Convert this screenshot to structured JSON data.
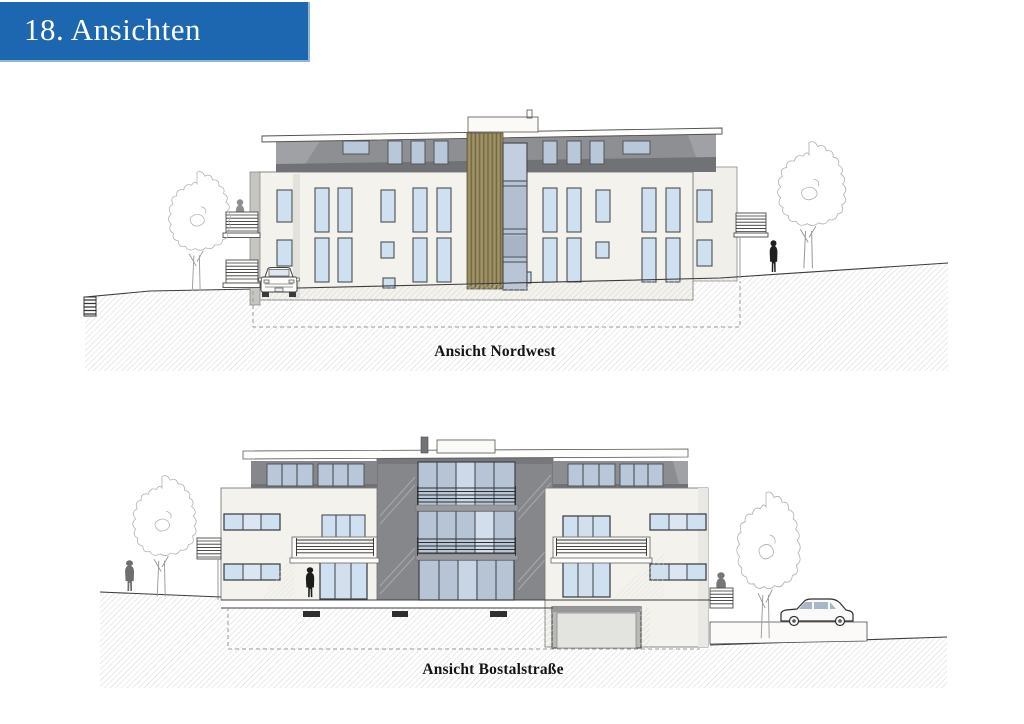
{
  "page": {
    "title": "18. Ansichten"
  },
  "drawings": [
    {
      "id": "nordwest",
      "caption": "Ansicht Nordwest"
    },
    {
      "id": "bostalstrasse",
      "caption": "Ansicht Bostalstraße"
    }
  ],
  "icons": {
    "trees": "deciduous-tree-sketch",
    "persons": "human-scale-figure",
    "car_front": "car-front-view",
    "car_side": "car-side-view"
  },
  "colors": {
    "accent": "#1c67b0",
    "facade": "#f4f2ec",
    "glass": "#cfe0f1",
    "glassDark": "#b7c3d5",
    "wood": "#968a5c",
    "woodLine": "#6f6444",
    "atticGray": "#8d8f92",
    "atticDark": "#707275",
    "centerGray": "#85878b",
    "hatchLine": "#d2d2d2",
    "ink": "#3c3c3c"
  }
}
